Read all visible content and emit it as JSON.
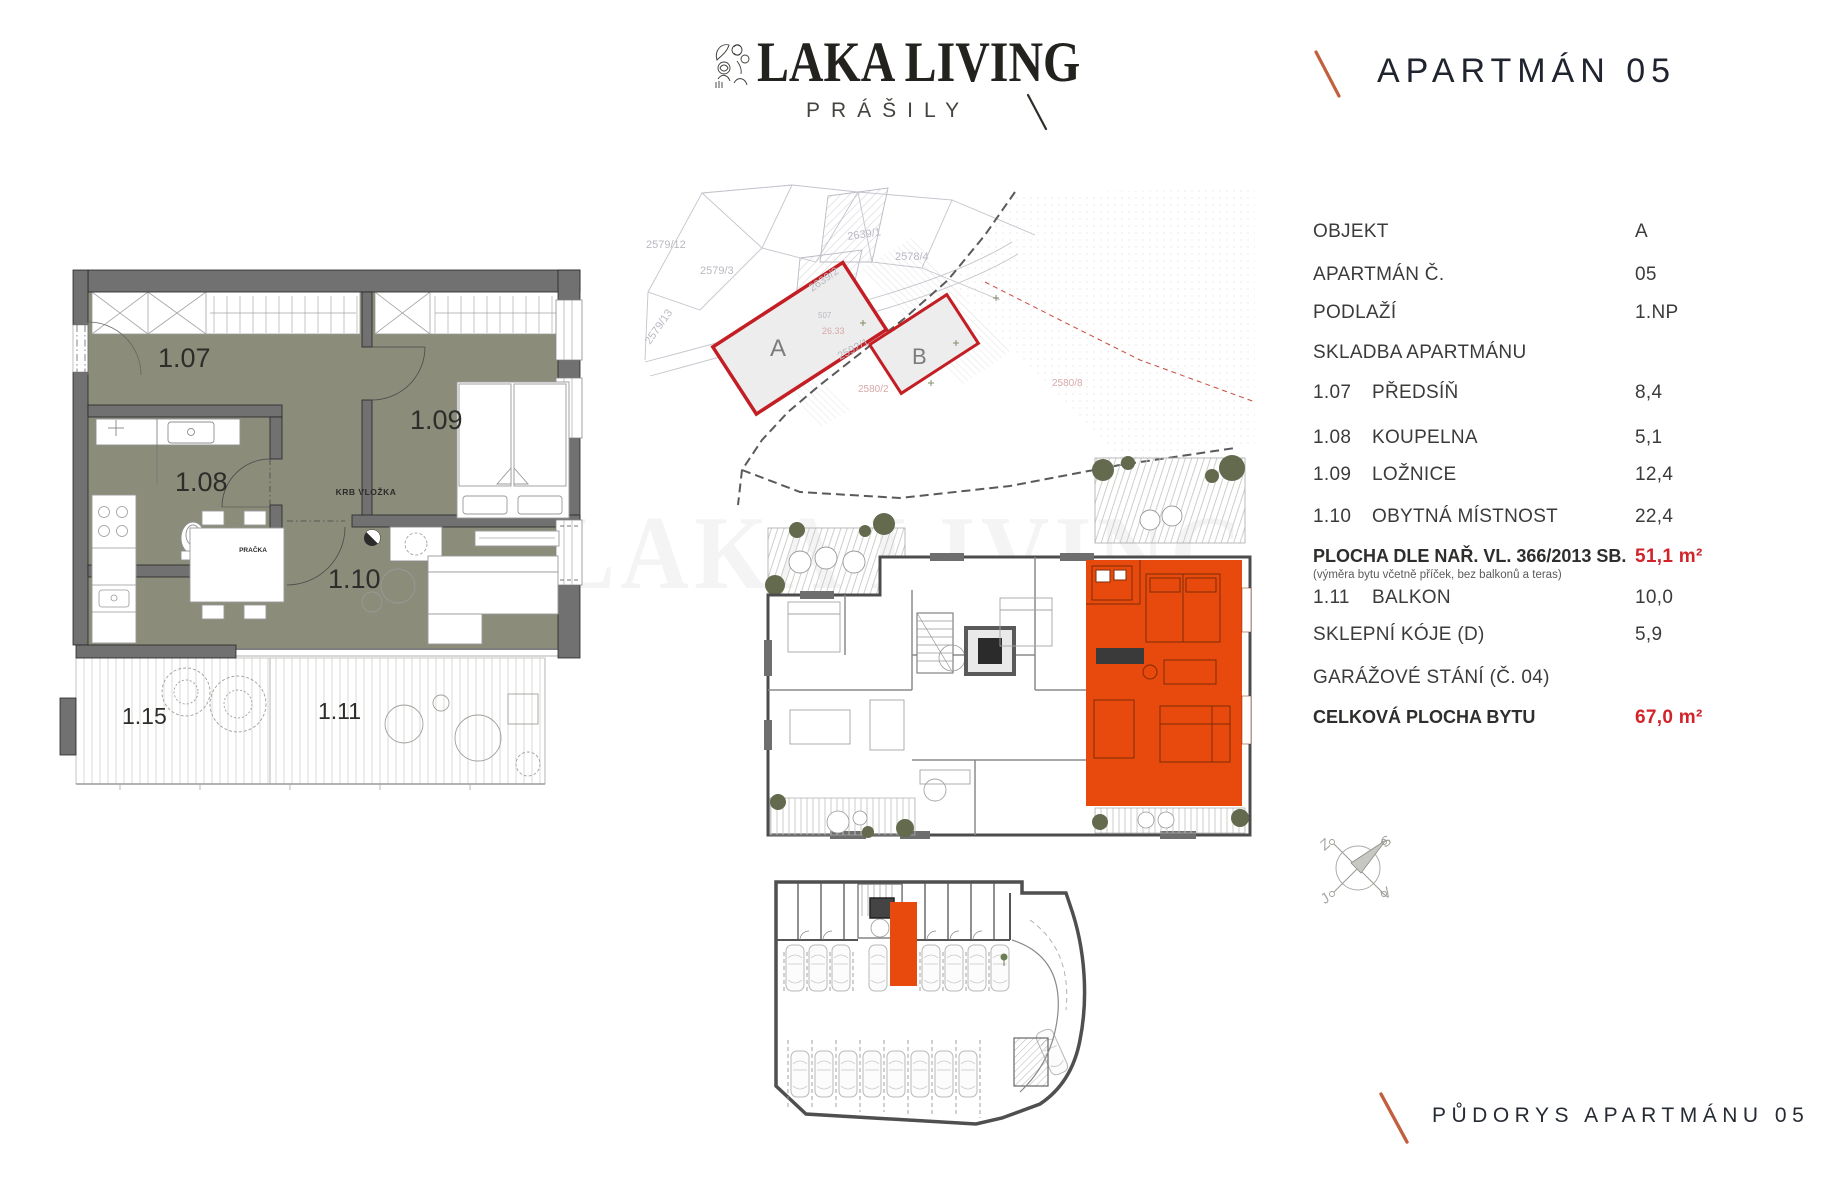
{
  "brand": {
    "name": "LAKA LIVING",
    "subtitle": "PRÁŠILY",
    "logo_icon": "botanical-stamp-icon"
  },
  "header": {
    "title": "APARTMÁN 05"
  },
  "footer": {
    "label": "PŮDORYS APARTMÁNU 05"
  },
  "info_table": {
    "rows": [
      {
        "code": "",
        "label": "OBJEKT",
        "value": "A"
      },
      {
        "code": "",
        "label": "APARTMÁN Č.",
        "value": "05"
      },
      {
        "code": "",
        "label": "PODLAŽÍ",
        "value": "1.NP"
      },
      {
        "code": "",
        "label": "SKLADBA APARTMÁNU",
        "value": ""
      },
      {
        "code": "1.07",
        "label": "PŘEDSÍŇ",
        "value": "8,4"
      },
      {
        "code": "1.08",
        "label": "KOUPELNA",
        "value": "5,1"
      },
      {
        "code": "1.09",
        "label": "LOŽNICE",
        "value": "12,4"
      },
      {
        "code": "1.10",
        "label": "OBYTNÁ MÍSTNOST",
        "value": "22,4"
      },
      {
        "code": "",
        "label": "PLOCHA DLE NAŘ. VL. 366/2013 SB.",
        "value": "51,1 m²",
        "note": "(výměra bytu včetně příček, bez balkonů a teras)"
      },
      {
        "code": "1.11",
        "label": "BALKON",
        "value": "10,0"
      },
      {
        "code": "",
        "label": "SKLEPNÍ KÓJE (D)",
        "value": "5,9"
      },
      {
        "code": "",
        "label": "GARÁŽOVÉ STÁNÍ (Č. 04)",
        "value": ""
      },
      {
        "code": "",
        "label": "CELKOVÁ PLOCHA BYTU",
        "value": "67,0 m²"
      }
    ]
  },
  "floor_plan": {
    "rooms": [
      {
        "id": "1.07"
      },
      {
        "id": "1.08"
      },
      {
        "id": "1.09"
      },
      {
        "id": "1.10"
      },
      {
        "id": "1.11"
      },
      {
        "id": "1.15"
      }
    ],
    "annotations": {
      "washer": "PRAČKA",
      "fireplace": "KRB VLOŽKA"
    }
  },
  "site_plan": {
    "buildings": [
      "A",
      "B"
    ],
    "area_label": "26.33",
    "parcels": [
      "2579/12",
      "2579/3",
      "2579/13",
      "2639/1",
      "2639/2",
      "2578/4",
      "2592/1",
      "2580/2",
      "2580/8",
      "507"
    ]
  },
  "compass": {
    "north": "S",
    "east": "V",
    "south": "J",
    "west": "Z"
  },
  "colors": {
    "accent_red": "#d2232a",
    "highlight_orange": "#e8490c",
    "slash_orange": "#c2603e",
    "floor_olive": "#8b8c7a",
    "wall_gray": "#717171"
  }
}
